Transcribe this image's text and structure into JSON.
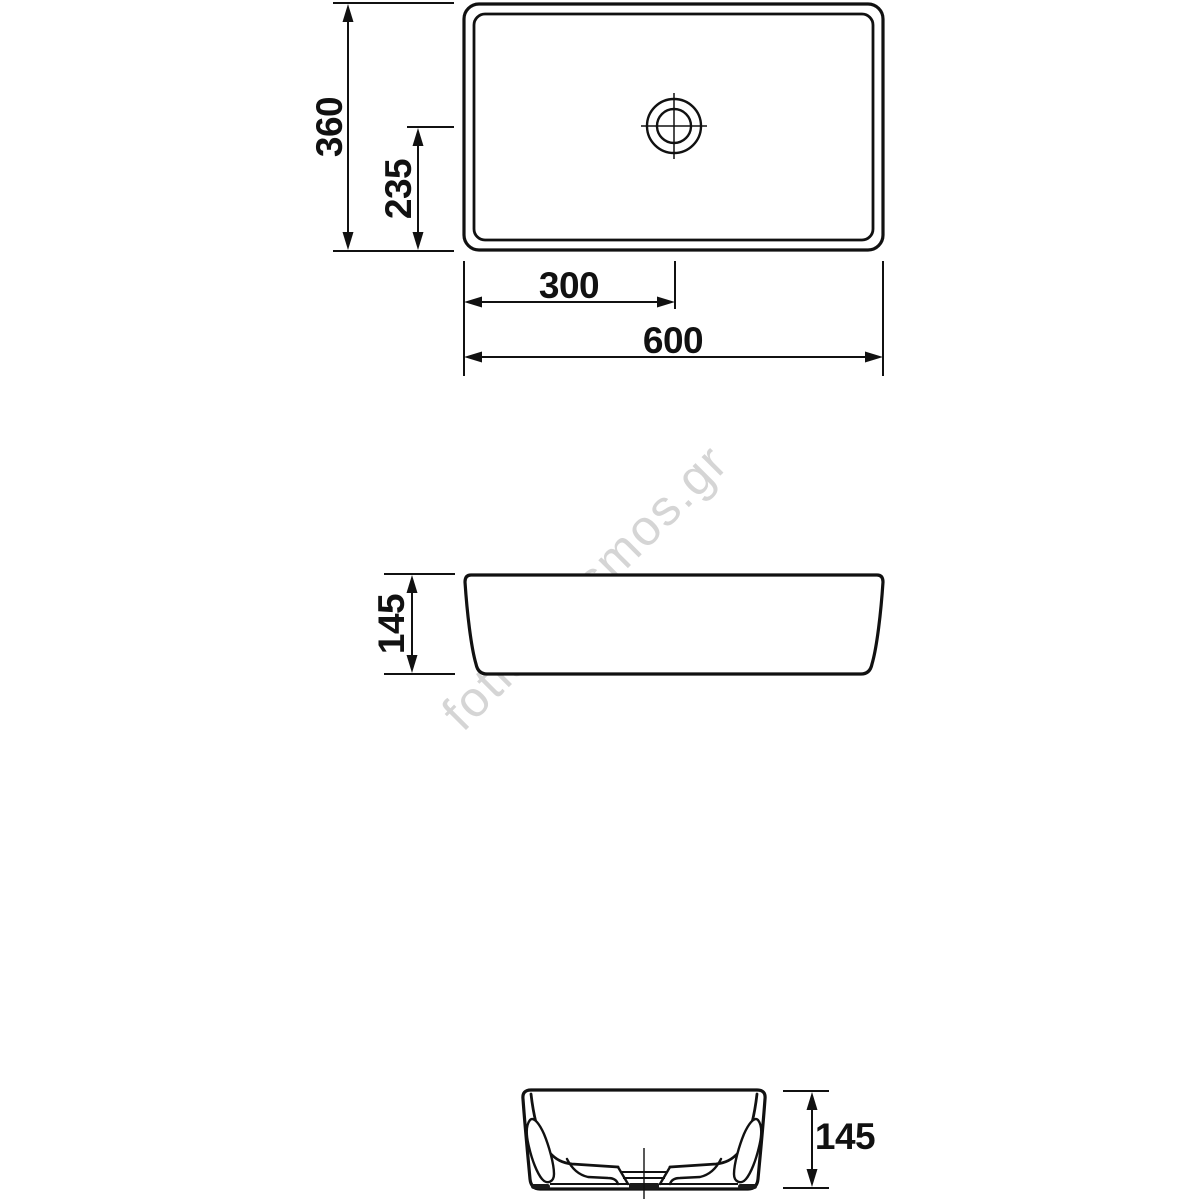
{
  "watermark": {
    "text": "fotistikosmos.gr",
    "color": "#d5d5d5"
  },
  "style": {
    "line_color": "#111111",
    "background": "#ffffff"
  },
  "views": {
    "top": {
      "label": "top view",
      "dimensions": {
        "depth": "360",
        "drain_offset_depth": "235",
        "drain_offset_width": "300",
        "width": "600"
      }
    },
    "front": {
      "label": "front view",
      "dimensions": {
        "height": "145"
      }
    },
    "side": {
      "label": "side section view",
      "dimensions": {
        "height": "145"
      }
    }
  }
}
